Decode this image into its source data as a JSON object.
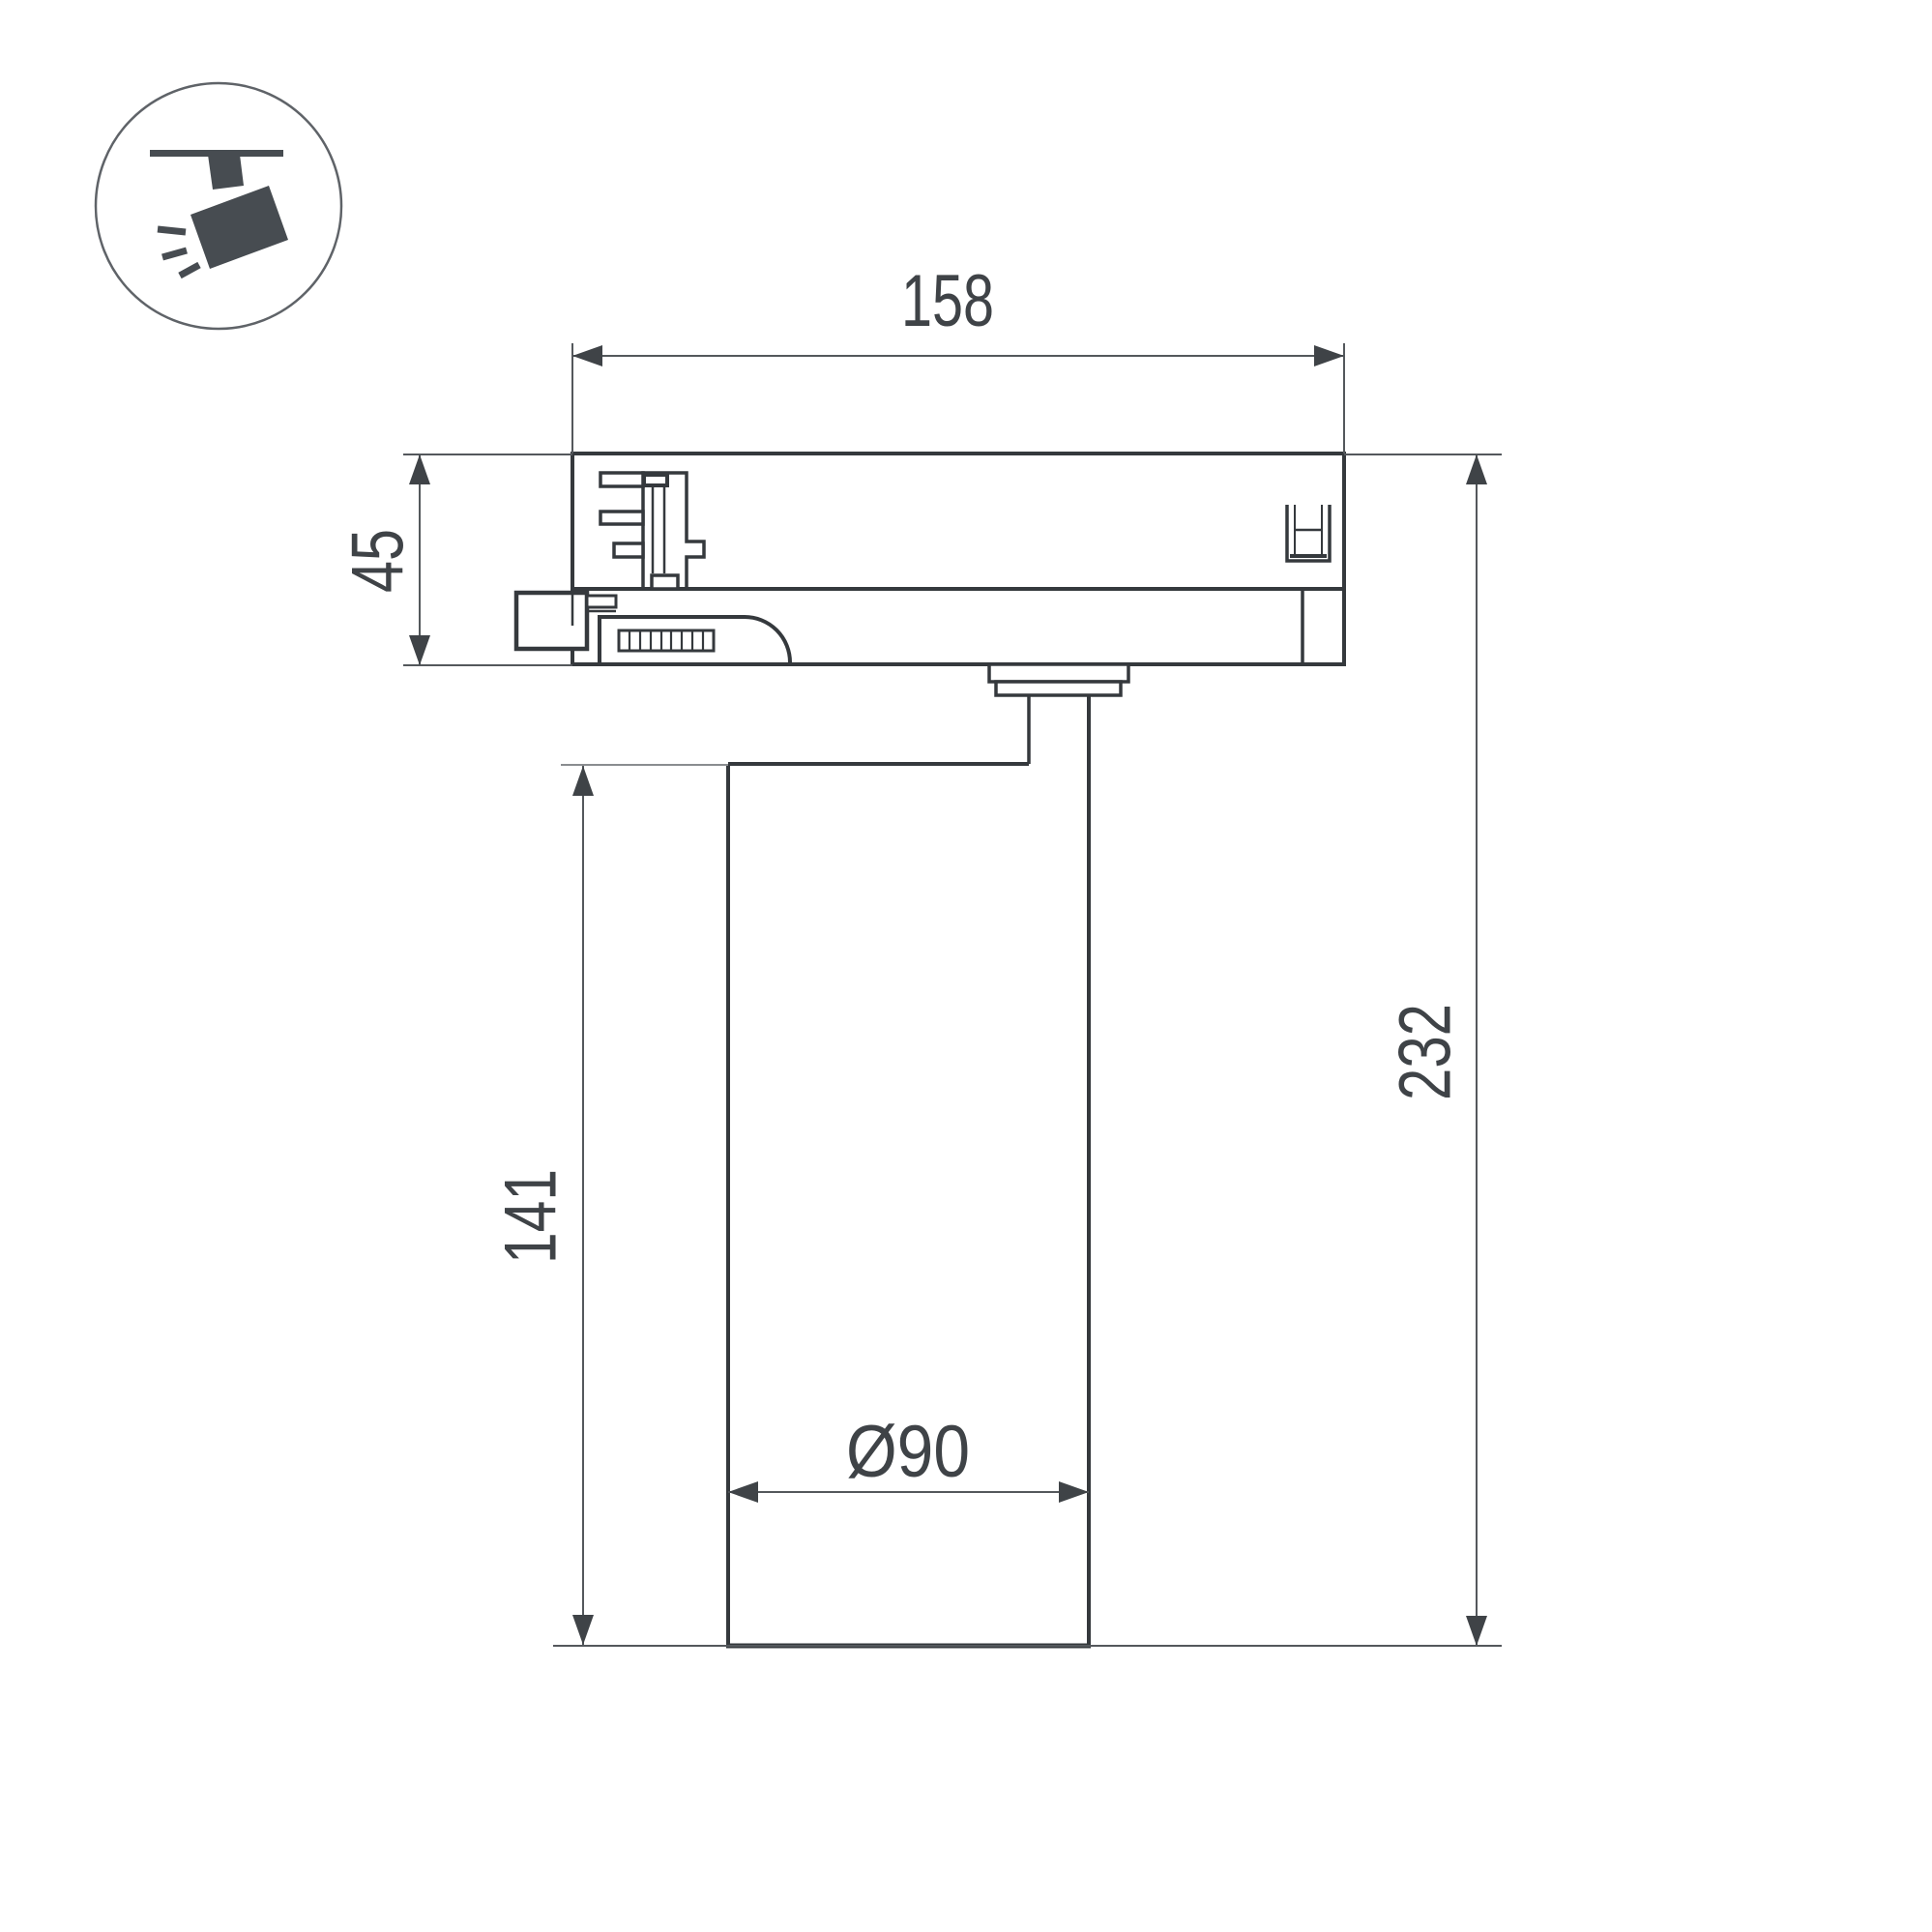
{
  "icon": {
    "name": "ceiling-track-spotlight"
  },
  "dimensions": {
    "track_width": "158",
    "adapter_height": "45",
    "total_height": "232",
    "body_height": "141",
    "body_diameter": "Ø90"
  },
  "colors": {
    "outline": "#35393d",
    "dimension_lines": "#54585c",
    "text": "#3f4347",
    "background": "#ffffff"
  }
}
